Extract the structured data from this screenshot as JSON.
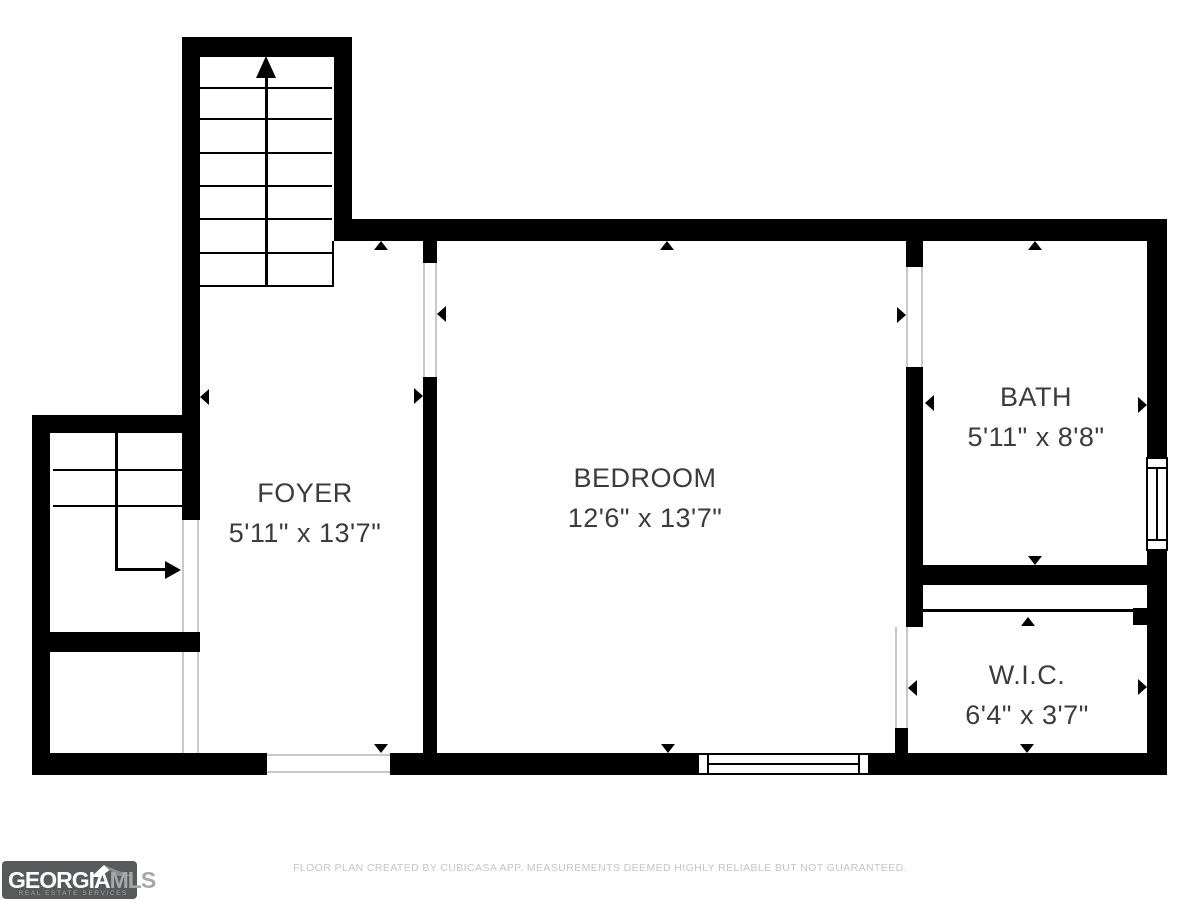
{
  "plan": {
    "rooms": [
      {
        "id": "foyer",
        "name": "FOYER",
        "dimensions": "5'11\" x 13'7\""
      },
      {
        "id": "bedroom",
        "name": "BEDROOM",
        "dimensions": "12'6\" x 13'7\""
      },
      {
        "id": "bath",
        "name": "BATH",
        "dimensions": "5'11\" x 8'8\""
      },
      {
        "id": "wic",
        "name": "W.I.C.",
        "dimensions": "6'4\" x 3'7\""
      }
    ]
  },
  "branding": {
    "logo_primary": "GEORGIA",
    "logo_secondary": "MLS",
    "logo_tagline": "REAL ESTATE SERVICES",
    "logo_background": "#58595b",
    "logo_primary_color": "#ffffff",
    "logo_secondary_color": "#a6a7a9"
  },
  "footer": {
    "disclaimer": "FLOOR PLAN CREATED BY CUBICASA APP. MEASUREMENTS DEEMED HIGHLY RELIABLE BUT NOT GUARANTEED."
  },
  "colors": {
    "wall": "#000000",
    "label_text": "#3c3c3c",
    "opening_line": "#c9c9c9",
    "footer_text": "#c5c5c5"
  }
}
